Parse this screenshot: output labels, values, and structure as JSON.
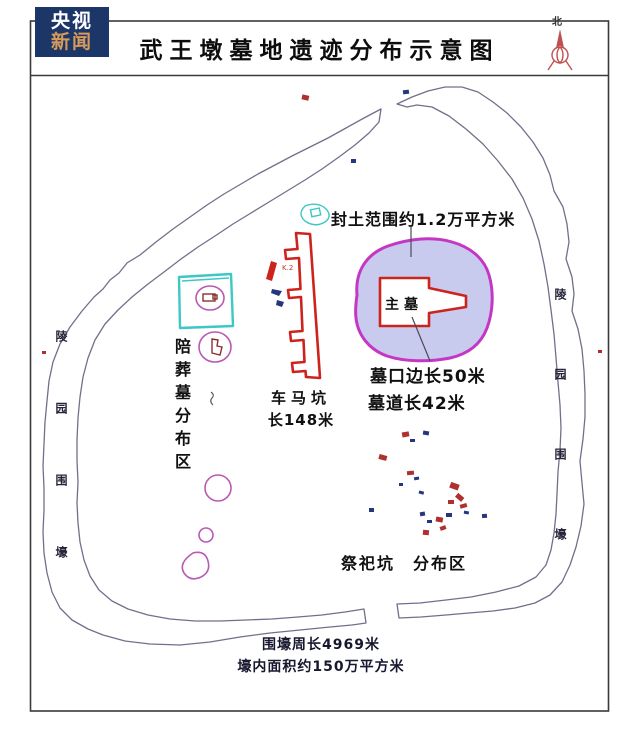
{
  "logo": {
    "line1": "央视",
    "line2": "新闻"
  },
  "header": {
    "title": "武王墩墓地遗迹分布示意图"
  },
  "compass": {
    "label": "北"
  },
  "map": {
    "mound_label": "封土范围约1.2万平方米",
    "main_tomb_label": "主墓",
    "tomb_side_label": "墓口边长50米",
    "tomb_passage_label": "墓道长42米",
    "chariot_pit_name": "车马坑",
    "chariot_pit_length": "长148米",
    "pit_code": "K.2",
    "accompany_tombs_label": "陪葬墓分布区",
    "sacrificial_pits_label": "祭祀坑　分布区",
    "moat_label_left": "陵园围壕",
    "moat_label_right": "陵园围壕",
    "moat_perimeter": "围壕周长4969米",
    "moat_area": "壕内面积约150万平方米"
  },
  "colors": {
    "logo_bg": "#1c3668",
    "logo_accent": "#d69a5a",
    "accent_red": "#cc241d",
    "mark_red": "#b03030",
    "magenta": "#c437c4",
    "mound_fill": "#c9cbee",
    "cyan": "#3cc8c4",
    "navy": "#24367e",
    "moat_line": "#70708a"
  }
}
